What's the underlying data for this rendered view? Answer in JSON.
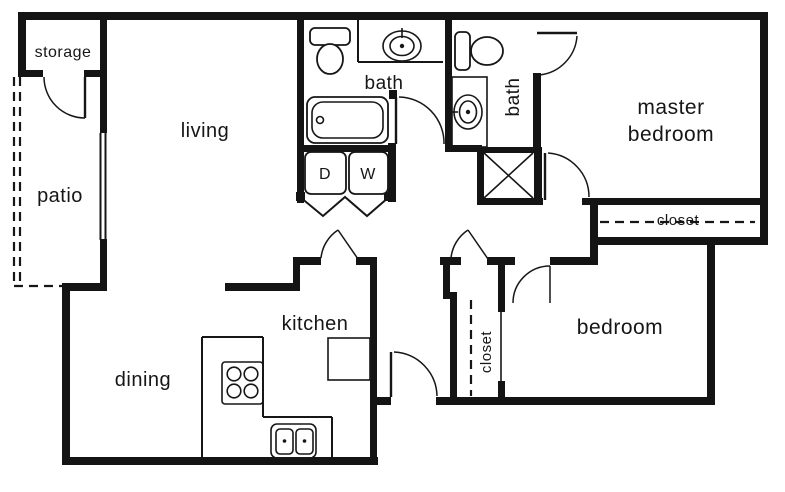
{
  "diagram_type": "apartment-floor-plan",
  "colors": {
    "ink": "#161616",
    "wall": "#141414",
    "background": "#ffffff"
  },
  "labels": {
    "storage": "storage",
    "patio": "patio",
    "living": "living",
    "dining": "dining",
    "kitchen": "kitchen",
    "bath_main": "bath",
    "bath_master": "bath",
    "master_bedroom_line1": "master",
    "master_bedroom_line2": "bedroom",
    "master_closet": "closet",
    "bedroom": "bedroom",
    "hall_closet": "closet",
    "dryer": "D",
    "washer": "W"
  },
  "fixtures": [
    "toilet-main-bath",
    "sink-main-bath",
    "bathtub",
    "dryer-unit",
    "washer-unit",
    "toilet-master-bath",
    "sink-master-bath",
    "shower-stall",
    "stove-4-burner",
    "kitchen-double-sink",
    "refrigerator",
    "kitchen-counter",
    "patio-sliding-door",
    "closet-rod-master",
    "closet-rod-hall"
  ],
  "doors": [
    "storage-door",
    "main-bath-door",
    "master-bath-door",
    "master-bedroom-door",
    "kitchen-hall-door",
    "hall-closet-door",
    "bedroom-door",
    "entry-door"
  ]
}
